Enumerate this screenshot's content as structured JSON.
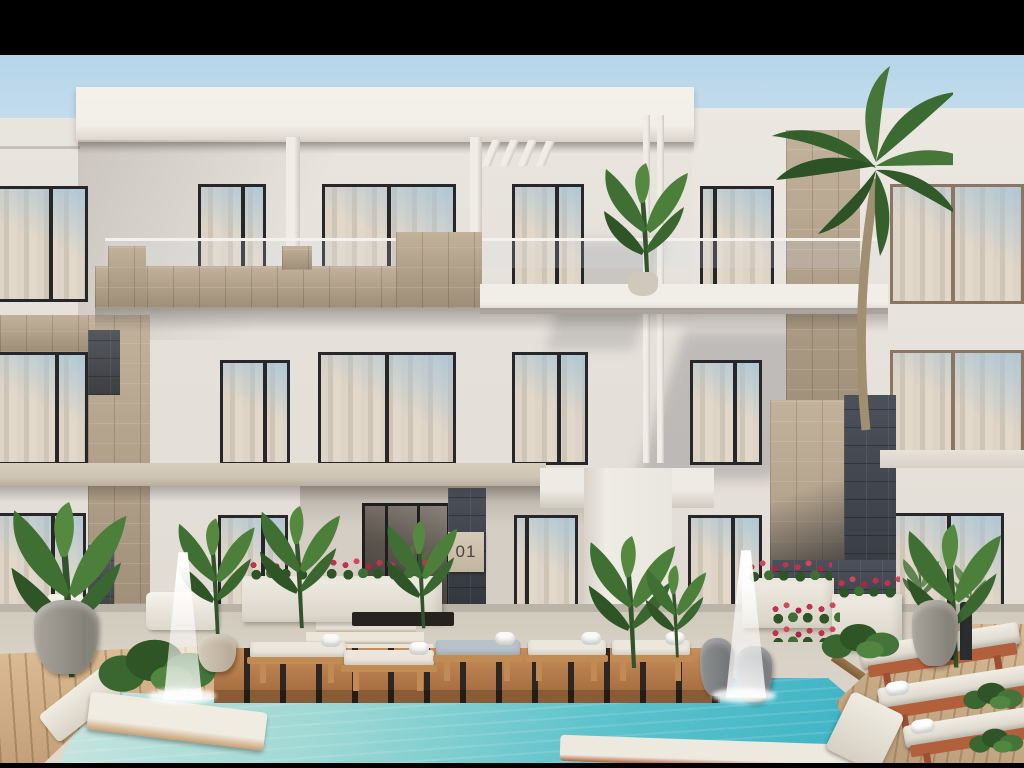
{
  "scene": {
    "type": "architectural-exterior-render",
    "description": "3D rendering of a modern white three-storey apartment building with travertine and dark slate stone accents, glass balcony railings, sheer-curtained windows, palm trees, flower planters, fountains, wooden sun decks with cushioned loungers and a turquoise swimming pool in the foreground, letterboxed with black bars.",
    "building": {
      "unit_sign": "01",
      "storeys": 3,
      "features": [
        "roof-slab",
        "pergola-fins",
        "glass-balustrade",
        "stone-parapet",
        "entrance-doors"
      ]
    },
    "amenities": [
      "swimming-pool",
      "sun-loungers",
      "in-pool-loungers",
      "fountains",
      "wood-decks",
      "planters"
    ],
    "colors": {
      "letterbox": "#000000",
      "sky_top": "#b6d5e9",
      "sky_bottom": "#eaf2f6",
      "facade": "#e8e4de",
      "facade_shade": "#d6d0c8",
      "roof_white": "#f2efe9",
      "slab_beige": "#cfc5b5",
      "stone_travertine": "#b2a28c",
      "stone_slate": "#3f434b",
      "frame_dark": "#27272a",
      "frame_bronze": "#8a7663",
      "curtain": "#d8cec0",
      "glass_reflection": "#a4c4d8",
      "pool_shallow": "#cfe7e1",
      "pool_deep": "#3eb3c4",
      "deck_wood": "#b97f4c",
      "deck_gap": "#2e2721",
      "wood_light": "#d4b189",
      "cushion_white": "#ece7dc",
      "lounger_wood": "#c18b54",
      "lounger_terracotta": "#b2603c",
      "plant_dark": "#2f5527",
      "plant_mid": "#3f6f33",
      "plant_light": "#55893f",
      "flower_red": "#c1334a",
      "pot_gray": "#8f8d89",
      "paving": "#d8d1c5",
      "white_trim": "#f4f1ec"
    }
  }
}
